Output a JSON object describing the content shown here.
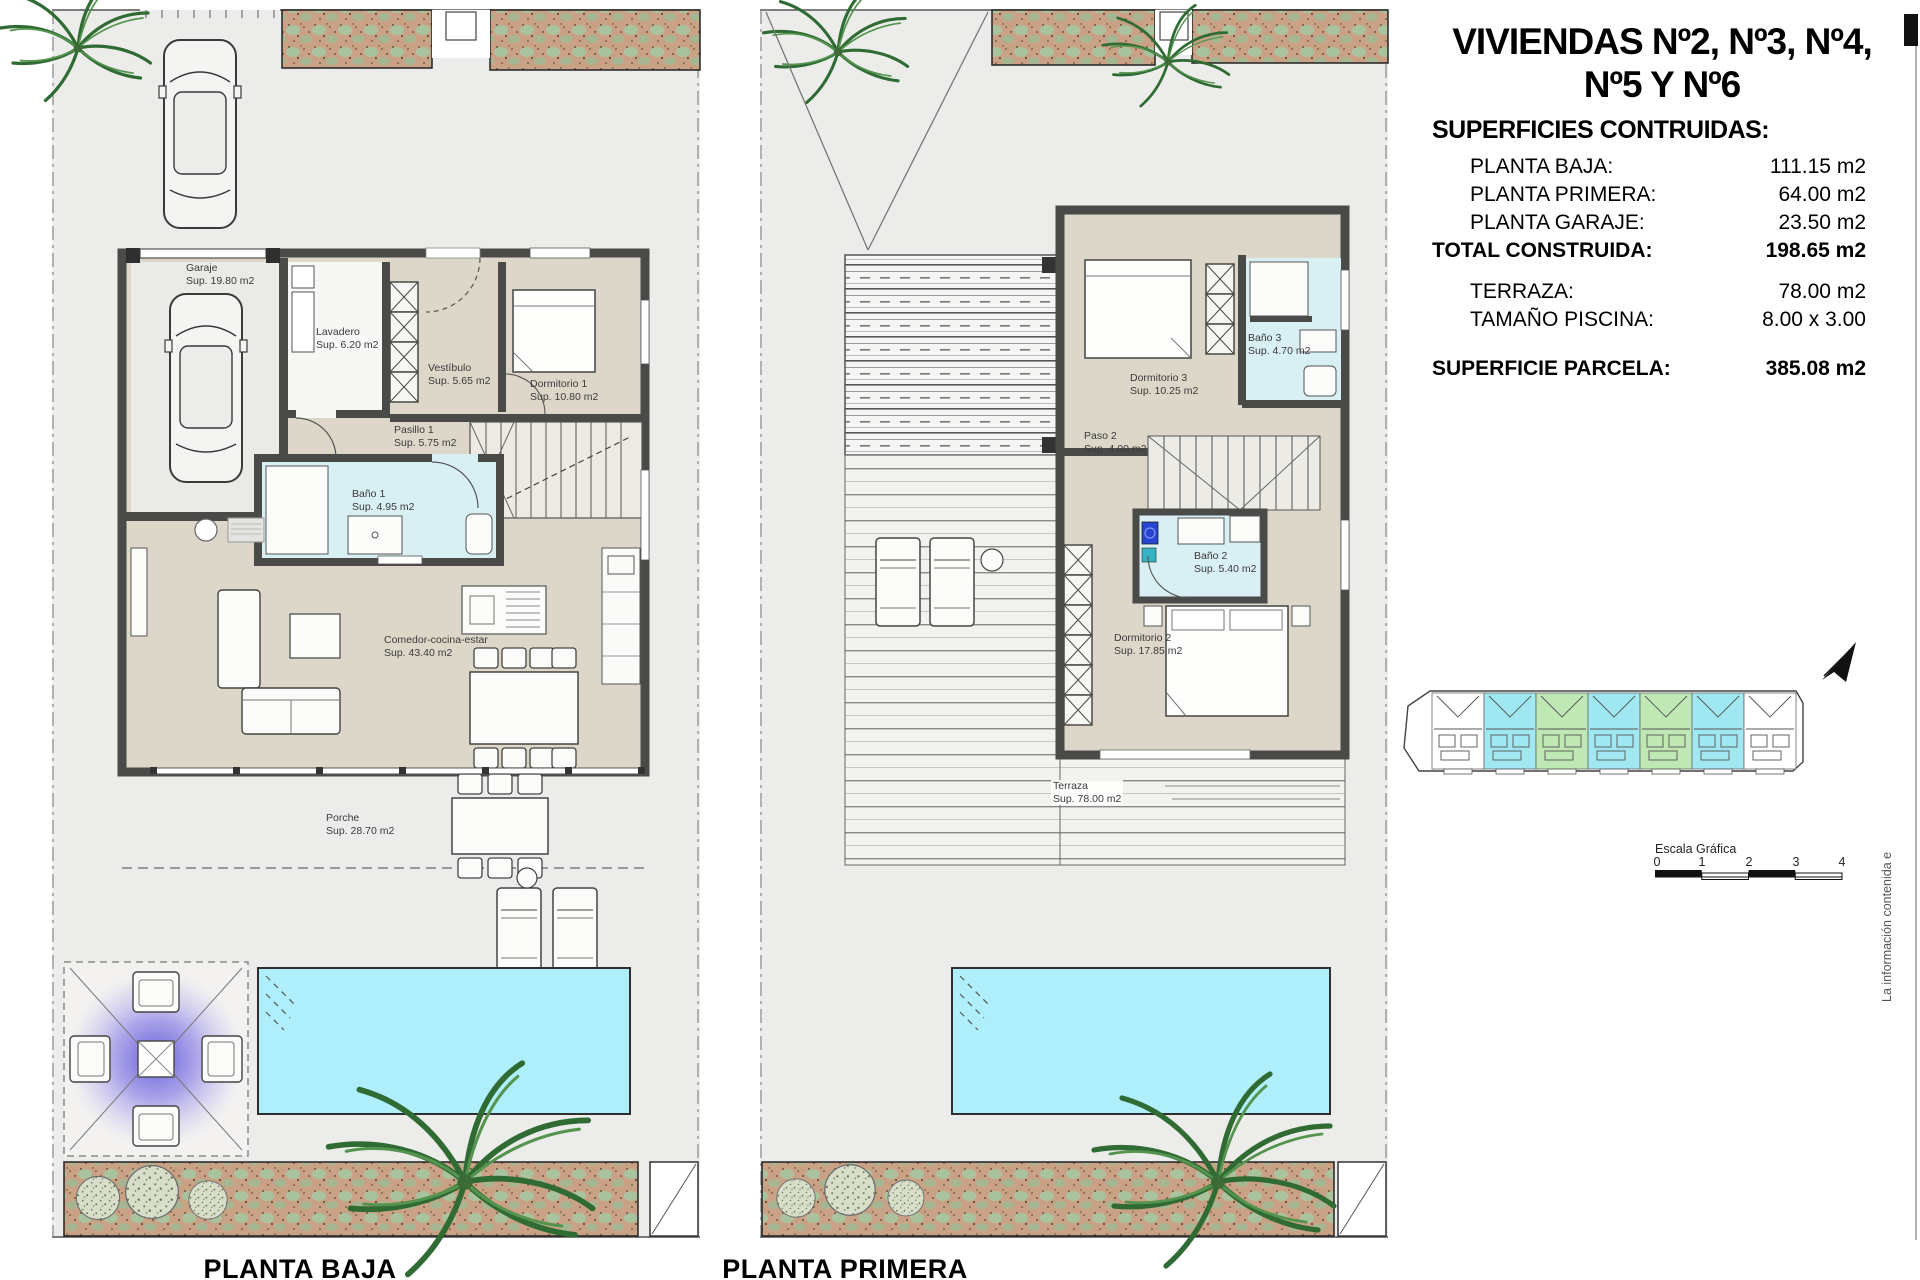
{
  "title": {
    "line1": "VIVIENDAS Nº2, Nº3, Nº4,",
    "line2": "Nº5 Y Nº6"
  },
  "summary": {
    "heading": "SUPERFICIES CONTRUIDAS:",
    "rows": [
      {
        "label": "PLANTA BAJA:",
        "value": "111.15 m2"
      },
      {
        "label": "PLANTA PRIMERA:",
        "value": "64.00 m2"
      },
      {
        "label": "PLANTA GARAJE:",
        "value": "23.50 m2"
      },
      {
        "label": "TOTAL CONSTRUIDA:",
        "value": "198.65 m2"
      },
      {
        "label": "TERRAZA:",
        "value": "78.00 m2"
      },
      {
        "label": "TAMAÑO PISCINA:",
        "value": "8.00 x 3.00"
      },
      {
        "label": "SUPERFICIE PARCELA:",
        "value": "385.08 m2"
      }
    ]
  },
  "ground_floor": {
    "caption": "PLANTA BAJA",
    "rooms": {
      "garaje": {
        "name": "Garaje",
        "area": "Sup. 19.80 m2"
      },
      "lavadero": {
        "name": "Lavadero",
        "area": "Sup. 6.20 m2"
      },
      "vestibulo": {
        "name": "Vestíbulo",
        "area": "Sup. 5.65 m2"
      },
      "dormitorio1": {
        "name": "Dormitorio 1",
        "area": "Sup. 10.80 m2"
      },
      "pasillo1": {
        "name": "Pasillo 1",
        "area": "Sup. 5.75 m2"
      },
      "bano1": {
        "name": "Baño 1",
        "area": "Sup. 4.95 m2"
      },
      "comedor": {
        "name": "Comedor-cocina-estar",
        "area": "Sup. 43.40 m2"
      },
      "porche": {
        "name": "Porche",
        "area": "Sup. 28.70 m2"
      }
    }
  },
  "first_floor": {
    "caption": "PLANTA PRIMERA",
    "rooms": {
      "dormitorio3": {
        "name": "Dormitorio 3",
        "area": "Sup. 10.25 m2"
      },
      "bano3": {
        "name": "Baño 3",
        "area": "Sup. 4.70 m2"
      },
      "paso2": {
        "name": "Paso 2",
        "area": "Sup. 4.00 m2"
      },
      "bano2": {
        "name": "Baño 2",
        "area": "Sup. 5.40 m2"
      },
      "dormitorio2": {
        "name": "Dormitorio 2",
        "area": "Sup. 17.85 m2"
      },
      "terraza": {
        "name": "Terraza",
        "area": "Sup. 78.00 m2"
      }
    }
  },
  "scale_bar": {
    "label": "Escala Gráfica",
    "ticks": [
      "0",
      "1",
      "2",
      "3",
      "4"
    ]
  },
  "side_note": "La información contenida e",
  "colors": {
    "pool": "#aeeffb",
    "bath_floor": "#d8eff3",
    "room_floor": "#dcd7c8",
    "wall": "#4a4a48",
    "planter_sand": "#c9a285",
    "parcel": "#ecedeb",
    "highlight_cyan": "#9fe8f2",
    "highlight_green": "#bfe8b4"
  },
  "siteplan": {
    "unit_fills": [
      "#ffffff",
      "#9fe8f2",
      "#bfe8b4",
      "#9fe8f2",
      "#bfe8b4",
      "#9fe8f2",
      "#ffffff"
    ]
  }
}
